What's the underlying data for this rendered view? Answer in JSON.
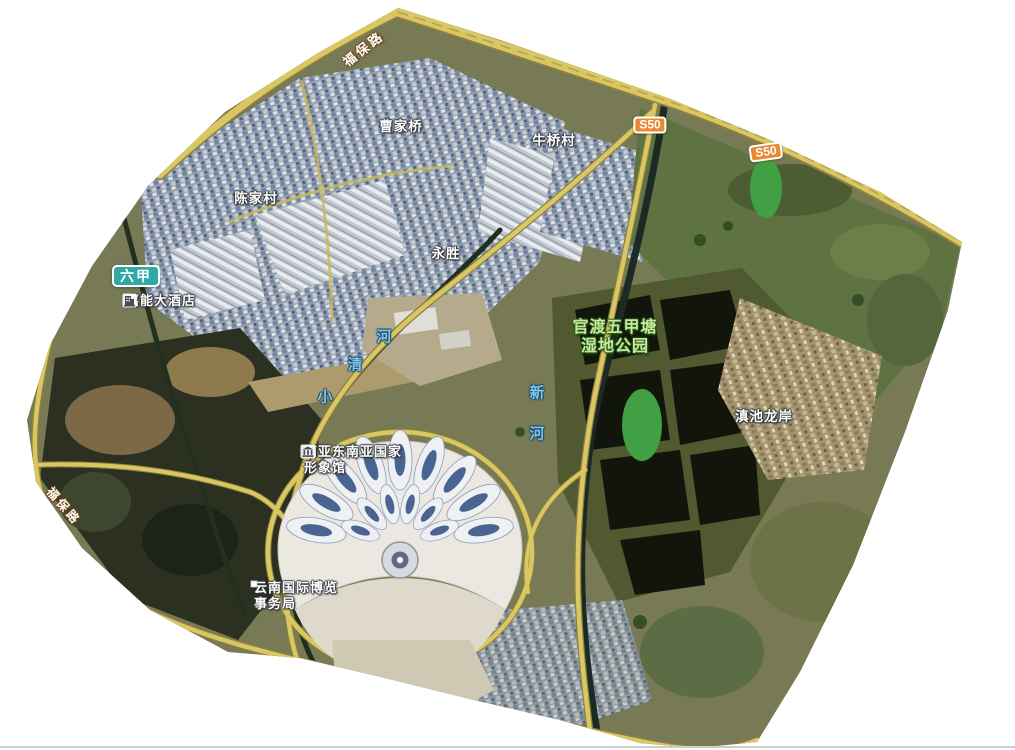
{
  "app": {
    "type": "satellite-web-map"
  },
  "map": {
    "colors": {
      "background": "#ffffff",
      "road_fill": "#d9c763",
      "road_casing": "#8d7f3e",
      "river_water": "#1f2c1e",
      "place_label_text": "#ffffff",
      "park_label_text": "#c6e8a0",
      "river_label_text": "#7cc6ef",
      "s50_badge_fill": "#e98a33",
      "area_badge_fill": "#2fa9a4"
    },
    "road_labels": {
      "fubao_top": {
        "text": "福保路"
      },
      "fubao_left": {
        "text": "福保路"
      },
      "s50_badges": [
        {
          "text": "S50"
        },
        {
          "text": "S50"
        }
      ]
    },
    "area_badge": {
      "text": "六甲"
    },
    "places": [
      {
        "text": "曹家桥"
      },
      {
        "text": "牛桥村"
      },
      {
        "text": "陈家村"
      },
      {
        "text": "永胜"
      },
      {
        "text": "滇池龙岸"
      }
    ],
    "park": {
      "line1": "官渡五甲塘",
      "line2": "湿地公园"
    },
    "rivers": [
      {
        "name": "小清河",
        "chars": [
          "河",
          "清",
          "小"
        ]
      },
      {
        "name": "新河",
        "chars": [
          "新",
          "河"
        ]
      }
    ],
    "pois": [
      {
        "name": "嘉能大酒店",
        "icon": "hotel-icon",
        "lines": [
          "嘉能大酒店"
        ]
      },
      {
        "name": "南亚东南亚国家形象馆",
        "icon": "museum-icon",
        "lines": [
          "南亚东南亚国家",
          "形象馆"
        ]
      },
      {
        "name": "云南国际博览事务局",
        "icon": "poi-dot-icon",
        "lines": [
          "云南国际博览",
          "事务局"
        ]
      }
    ]
  }
}
